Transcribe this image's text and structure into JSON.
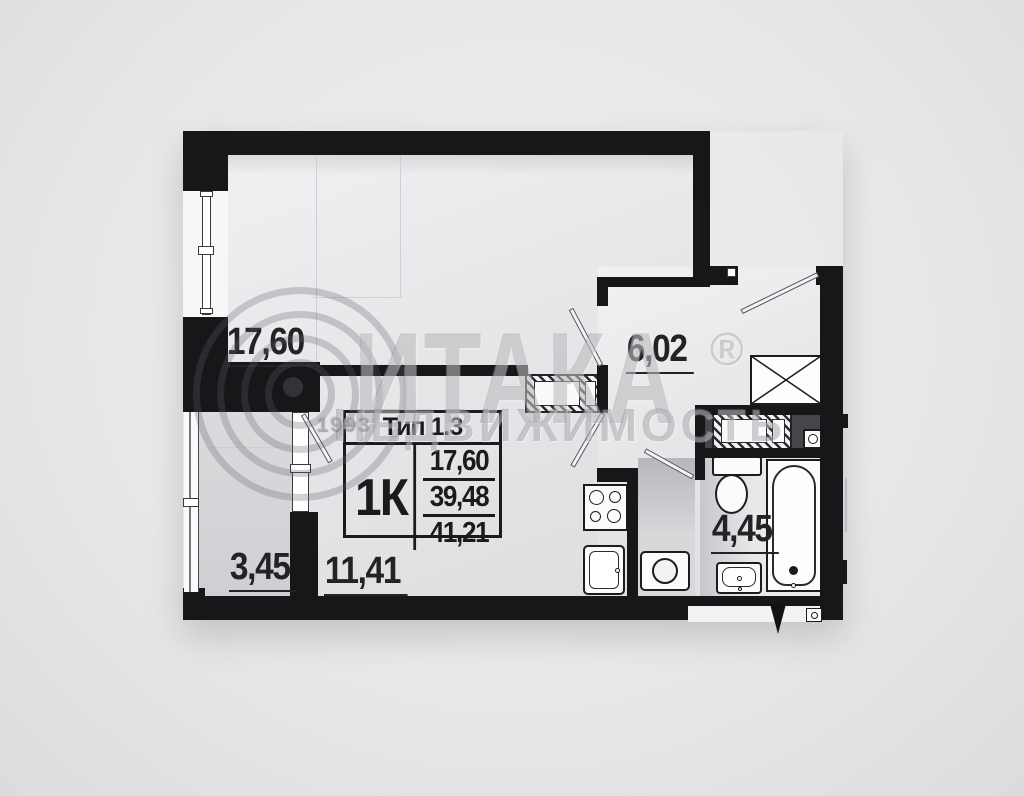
{
  "watermark": {
    "brand": "ИТАКА",
    "registered_mark": "®",
    "subtitle": "НЕДВИЖИМОСТЬ",
    "year": "1993"
  },
  "unit_info": {
    "type": "Тип 1.3",
    "rooms": "1К",
    "areas": {
      "living": "17,60",
      "without_balcony": "39,48",
      "total": "41,21"
    }
  },
  "rooms": {
    "living": {
      "area": "17,60"
    },
    "hallway": {
      "area": "6,02"
    },
    "balcony": {
      "area": "3,45"
    },
    "kitchen": {
      "area": "11,41"
    },
    "bathroom": {
      "area": "4,45"
    }
  },
  "fixtures": {
    "wardrobe": "crossed-box",
    "vent_shaft": "hatched-box",
    "vent_grille": "box-with-circle",
    "stove": "four-burners",
    "kitchen_sink": "rounded-basin",
    "washing_machine": "box-with-drum-circle",
    "toilet": "tank-and-bowl",
    "bathtub": "rounded-tub",
    "bathroom_sink": "basin"
  },
  "colors": {
    "wall": "#17171a",
    "floor": "#e7e7e9",
    "background": "#e9e9eb",
    "dark_niche": "#46464b",
    "watermark": "#64646c"
  }
}
